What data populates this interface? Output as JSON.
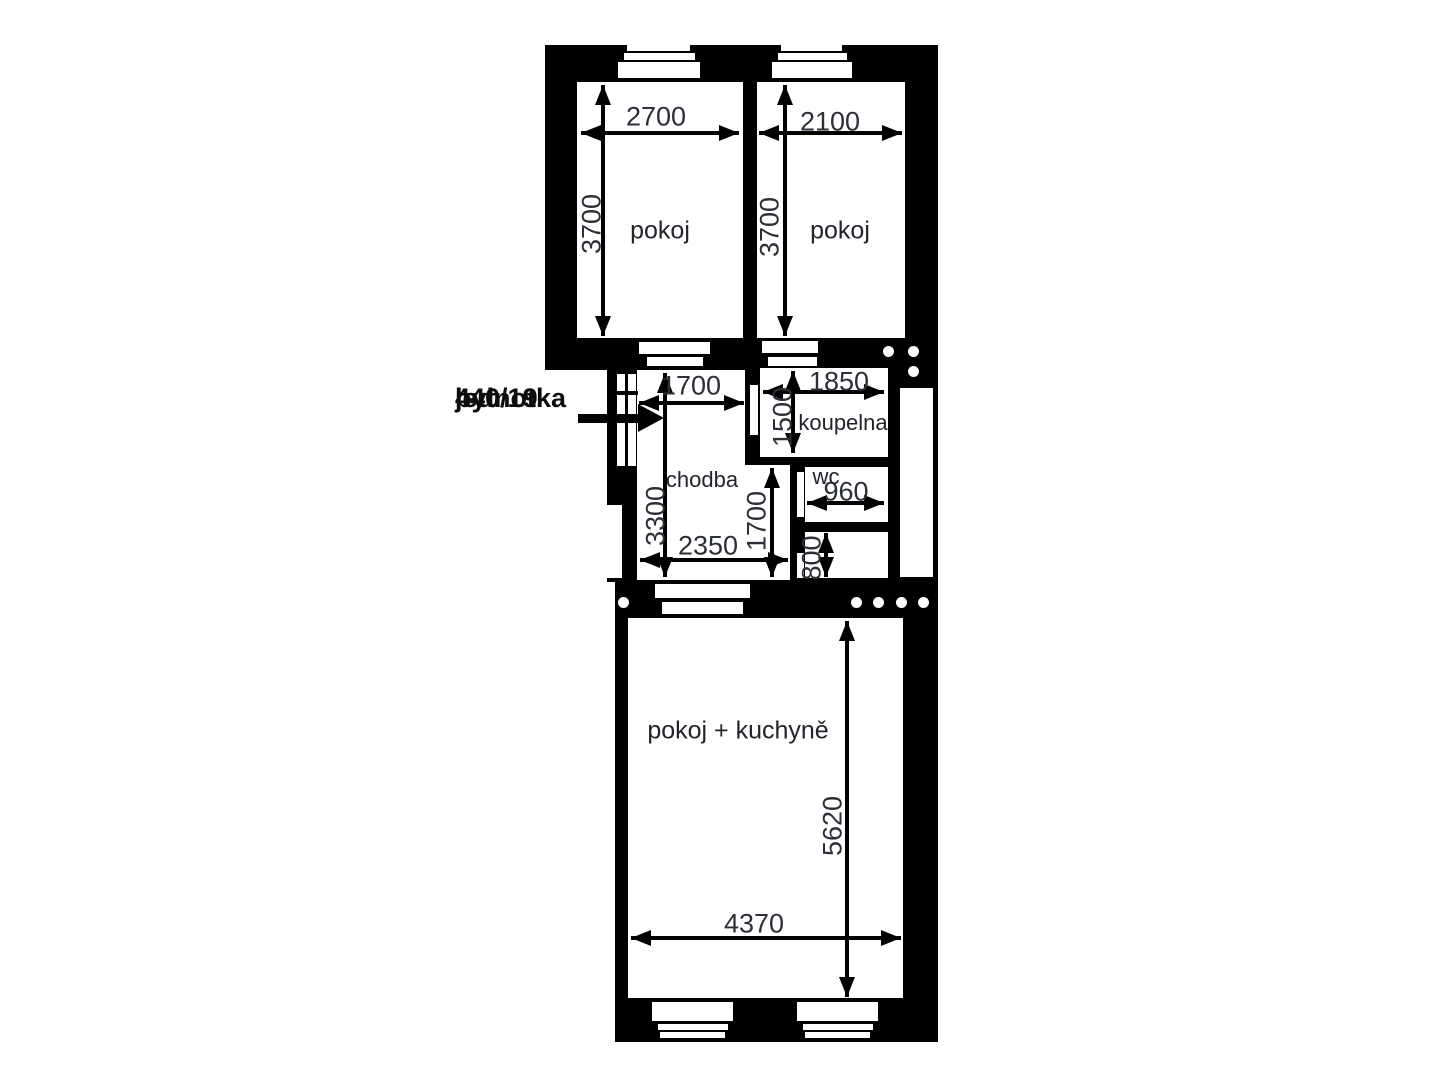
{
  "annotation": {
    "line1": "jednotka",
    "line2": "440/19",
    "line3": "byt"
  },
  "rooms": {
    "pokoj_left": {
      "label": "pokoj",
      "width": "2700",
      "height": "3700"
    },
    "pokoj_right": {
      "label": "pokoj",
      "width": "2100",
      "height": "3700"
    },
    "chodba": {
      "label": "chodba",
      "width_top": "1700",
      "height_left": "3300",
      "width_bottom": "2350",
      "height_right": "1700"
    },
    "koupelna": {
      "label": "koupelna",
      "width": "1850",
      "height": "1500"
    },
    "wc": {
      "label": "wc",
      "width": "960"
    },
    "komora": {
      "height": "800"
    },
    "pokoj_kuchyne": {
      "label": "pokoj + kuchyně",
      "width": "4370",
      "height": "5620"
    }
  },
  "colors": {
    "wall": "#000000",
    "floor": "#ffffff",
    "dim_text": "#2b2f38"
  }
}
